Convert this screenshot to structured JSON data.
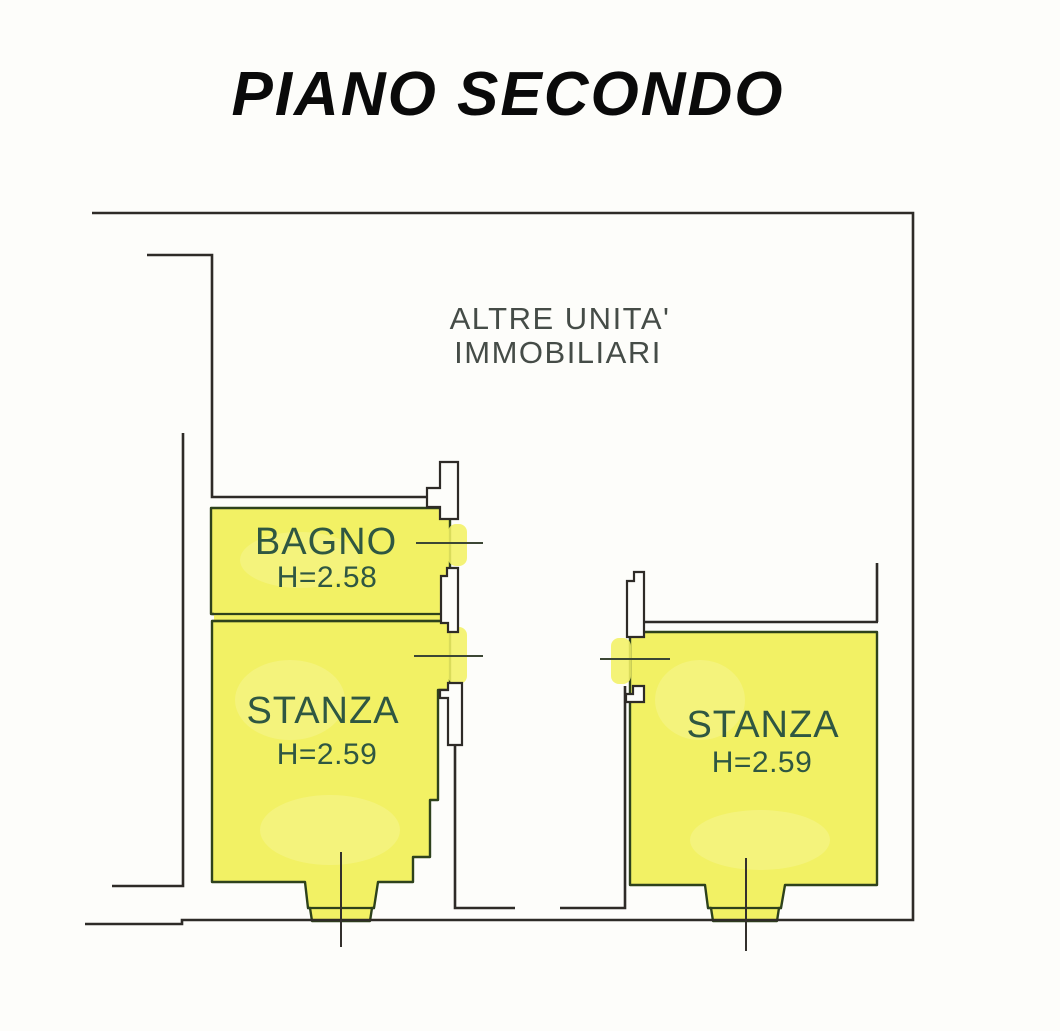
{
  "title": "PIANO SECONDO",
  "floor_plan": {
    "area_label": {
      "line1": "ALTRE UNITA'",
      "line2": "IMMOBILIARI"
    },
    "rooms": [
      {
        "name": "BAGNO",
        "height": "H=2.58"
      },
      {
        "name": "STANZA",
        "height": "H=2.59"
      },
      {
        "name": "STANZA",
        "height": "H=2.59"
      }
    ],
    "colors": {
      "highlight_yellow": "#f2f164",
      "room_border_green": "#2e421c",
      "wall_black": "#2e2b27",
      "label_green": "#2f5742",
      "area_label_gray": "#454c47",
      "title_black": "#0a0a0a",
      "background": "#fdfdfa"
    }
  }
}
